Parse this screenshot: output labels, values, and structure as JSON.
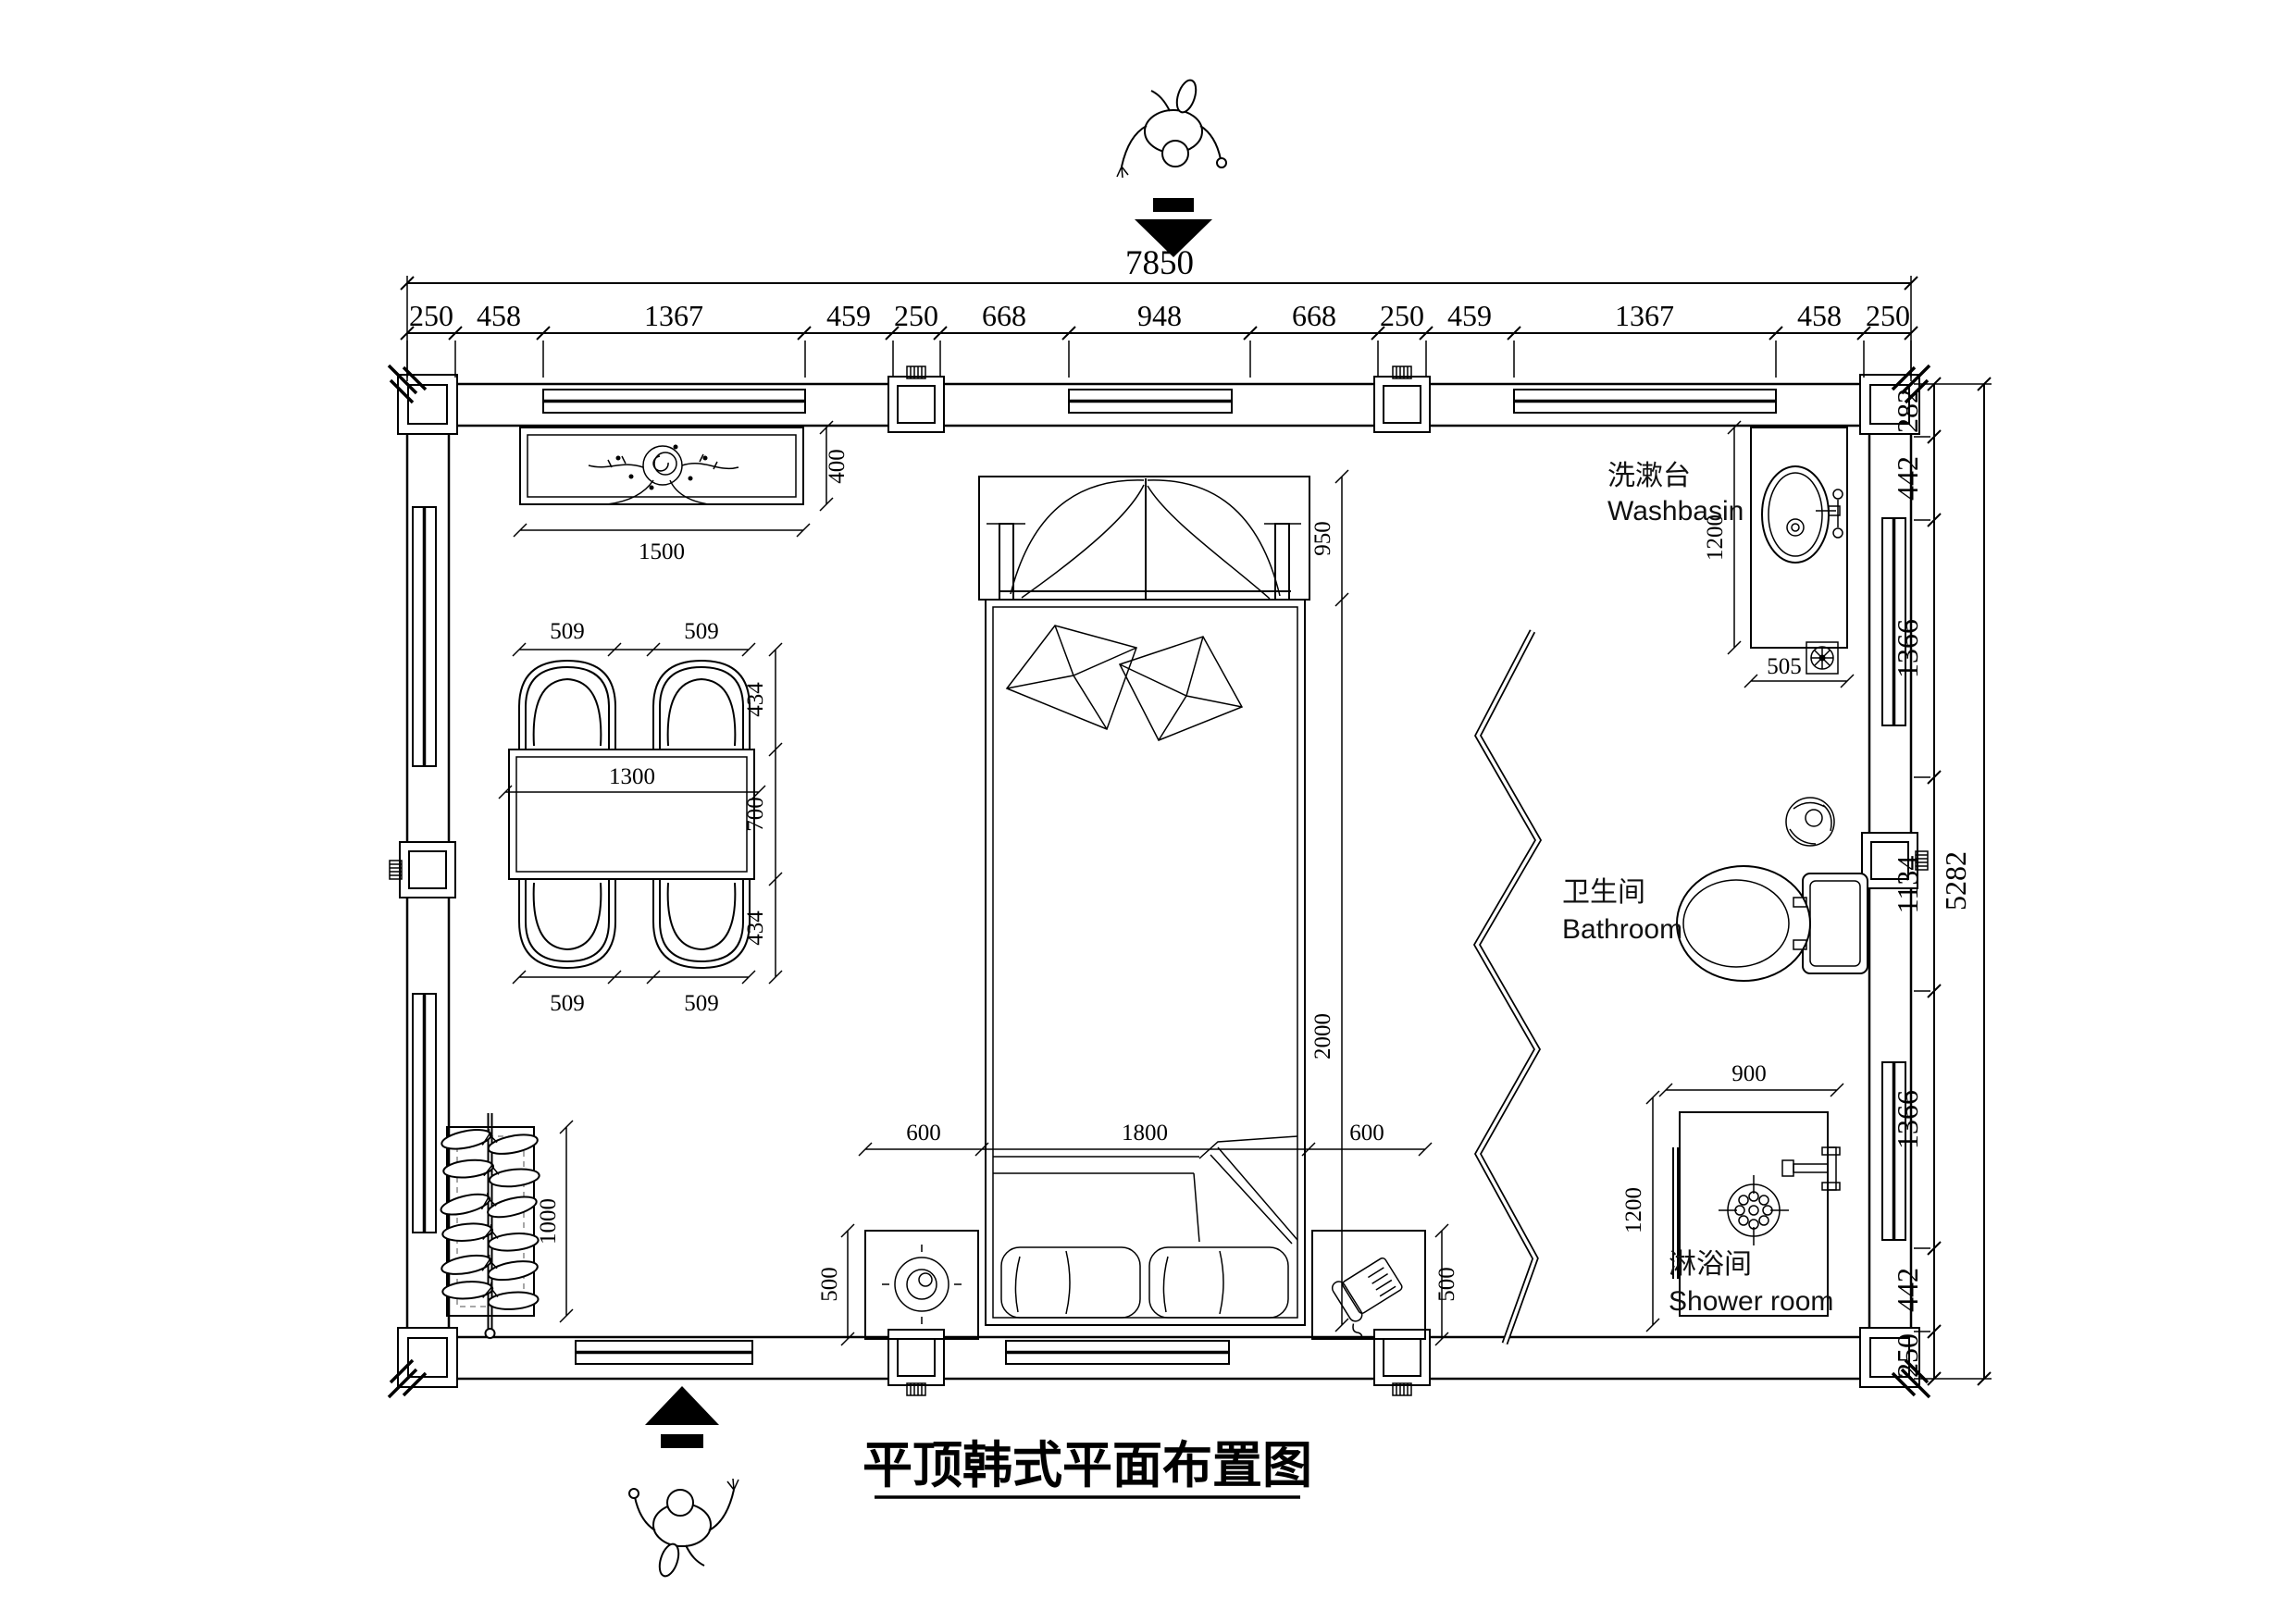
{
  "title": "平顶韩式平面布置图",
  "chains": {
    "top_total": "7850",
    "top": [
      "250",
      "458",
      "1367",
      "459",
      "250",
      "668",
      "948",
      "668",
      "250",
      "459",
      "1367",
      "458",
      "250"
    ],
    "right": [
      "282",
      "442",
      "1366",
      "1134",
      "1366",
      "442",
      "250"
    ],
    "right_total": "5282"
  },
  "rooms": {
    "washbasin_zh": "洗漱台",
    "washbasin_en": "Washbasin",
    "bathroom_zh": "卫生间",
    "bathroom_en": "Bathroom",
    "shower_zh": "淋浴间",
    "shower_en": "Shower room"
  },
  "furn": {
    "cabinet_w": "1500",
    "cabinet_d": "400",
    "chair_w": "509",
    "chair_d": "434",
    "table_w": "1300",
    "table_d": "700",
    "canopy_d": "950",
    "bed_w": "1800",
    "bed_l": "2000",
    "stand_w": "600",
    "stand_d": "500",
    "rack_l": "1000",
    "basin_l": "1200",
    "basin_w": "505",
    "shower_w": "900",
    "shower_d": "1200"
  }
}
